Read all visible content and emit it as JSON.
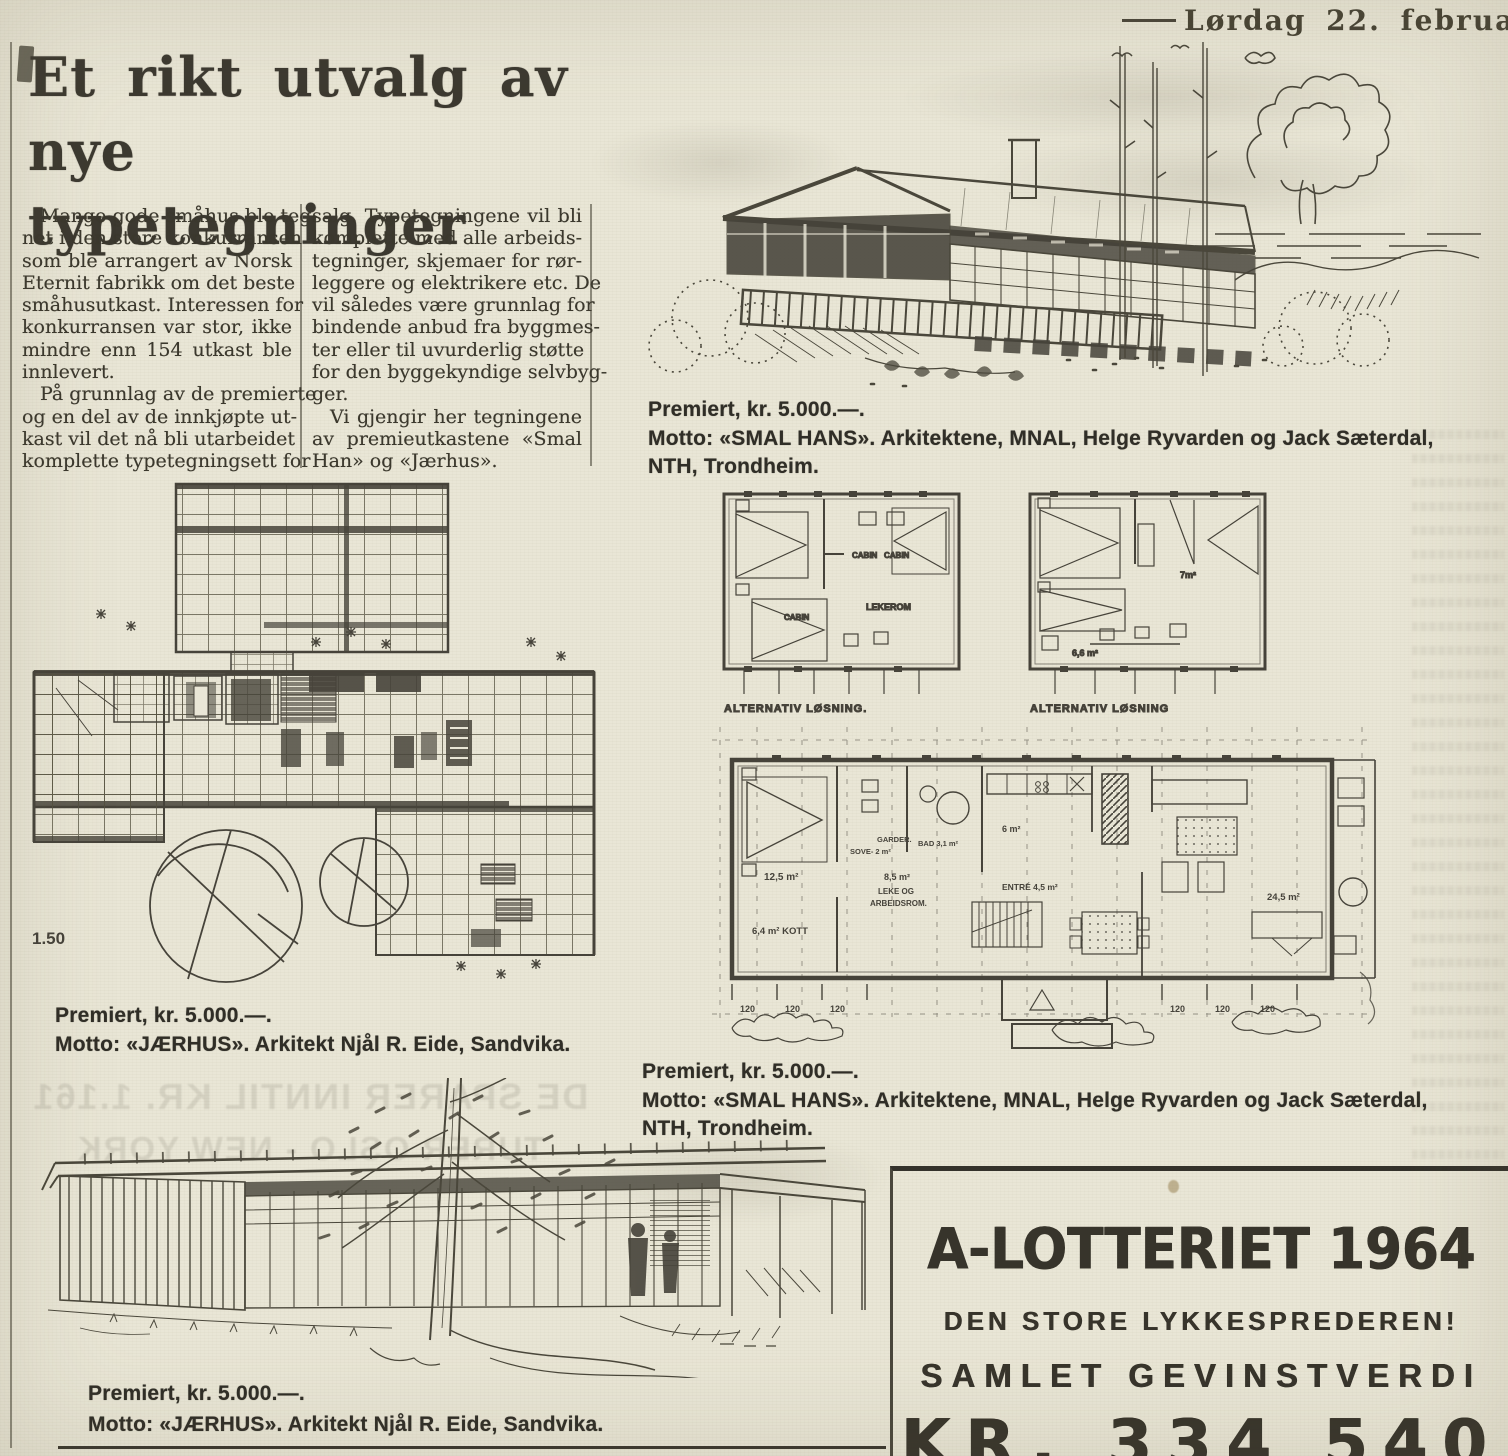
{
  "masthead": {
    "date": "Lørdag 22. februar 1964"
  },
  "headline": {
    "line1": "Et rikt utvalg av",
    "line2": "nye typetegninger"
  },
  "article": {
    "col1": [
      "Mange gode småhus ble teg-",
      "net i den store konkurransen",
      "som ble arrangert av Norsk",
      "Eternit fabrikk om det beste",
      "småhusutkast. Interessen for",
      "konkurransen var stor, ikke",
      "mindre enn 154 utkast ble",
      "innlevert.",
      "På grunnlag av de premierte",
      "og en del av de innkjøpte ut-",
      "kast vil det nå bli utarbeidet",
      "komplette typetegningsett for"
    ],
    "col2": [
      "salg. Typetegningene vil bli",
      "komplette med alle arbeids-",
      "tegninger, skjemaer for rør-",
      "leggere og elektrikere etc. De",
      "vil således være grunnlag for",
      "bindende anbud fra byggmes-",
      "ter eller til uvurderlig støtte",
      "for den byggekyndige selvbyg-",
      "ger.",
      "Vi gjengir her tegningene",
      "av premieutkastene «Smal",
      "Han» og «Jærhus»."
    ]
  },
  "captions": {
    "house_top": [
      "Premiert, kr. 5.000.—.",
      "Motto: «SMAL HANS». Arkitektene, MNAL, Helge Ryvarden og Jack Sæterdal,",
      "NTH, Trondheim."
    ],
    "plan_left": [
      "Premiert, kr. 5.000.—.",
      "Motto: «JÆRHUS». Arkitekt Njål R. Eide,  Sandvika."
    ],
    "plans_right": [
      "Premiert, kr. 5.000.—.",
      "Motto: «SMAL HANS». Arkitektene, MNAL, Helge Ryvarden og Jack Sæterdal,",
      "NTH, Trondheim."
    ],
    "house_bottom": [
      "Premiert, kr. 5.000.—.",
      "Motto: «JÆRHUS». Arkitekt Njål R. Eide,  Sandvika."
    ]
  },
  "plans": {
    "site_plan_scale": "1.50",
    "alt_label_1": "ALTERNATIV LØSNING.",
    "alt_label_2": "ALTERNATIV LØSNING",
    "small_rooms": {
      "cabin_a": "CABIN",
      "cabin_b": "CABIN",
      "cabin_c": "CABIN",
      "lekerom": "LEKEROM",
      "room_7": "7m²",
      "room_66": "6,6 m²"
    },
    "long_rooms": {
      "r125": "12,5 m²",
      "sove": "SOVE- 2 m²",
      "garder": "GARDER.",
      "bad": "BAD 3,1 m²",
      "r6": "6 m²",
      "leke1": "8,5 m²",
      "leke2": "LEKE OG",
      "leke3": "ARBEIDSROM.",
      "kott": "6,4 m² KOTT",
      "entre": "ENTRÉ 4,5 m²",
      "stue": "24,5 m²"
    },
    "dims_left": [
      "120",
      "120",
      "120"
    ],
    "dims_right": [
      "120",
      "120",
      "120"
    ]
  },
  "bleedthrough": {
    "line1": "DE SPARER INNTIL KR. 1.161",
    "line2": "TURER OSLO - NEW YORK"
  },
  "ad": {
    "title": "A-LOTTERIET 1964",
    "subtitle": "DEN STORE LYKKESPREDEREN!",
    "line3": "SAMLET GEVINSTVERDI",
    "amount": "KR. 334 540"
  },
  "colors": {
    "paper": "#e9e6d6",
    "ink": "#4a473b",
    "text": "#3b382e"
  }
}
